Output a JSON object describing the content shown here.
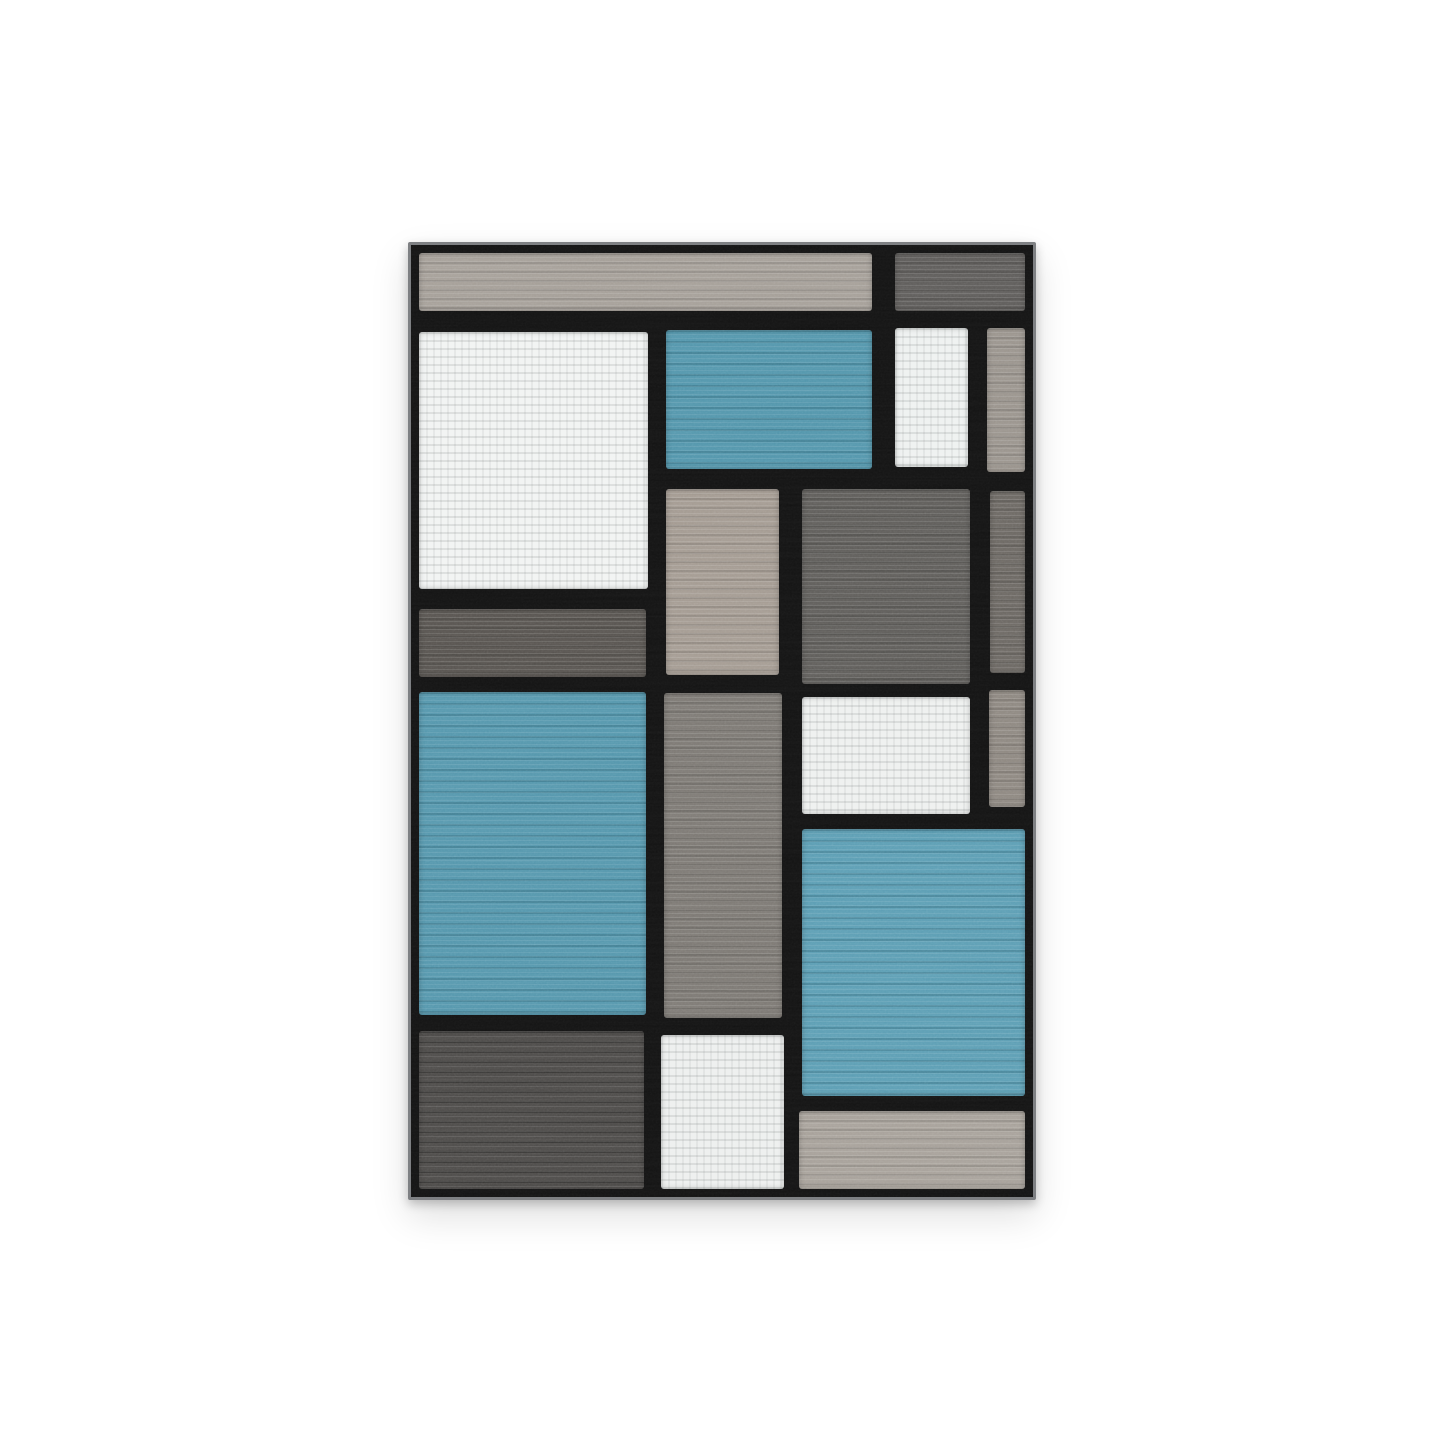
{
  "scene": {
    "description": "Product photo of a modern abstract color-block area rug with blue, gray, taupe and white rectangles separated by thick black grid lines, centered on a plain white background",
    "background_color": "#ffffff"
  },
  "rug": {
    "frame": {
      "left_pct": 28.24,
      "top_pct": 16.75,
      "width_pct": 43.46,
      "height_pct": 66.3
    },
    "grid_size": {
      "w": 628,
      "h": 958
    },
    "base_line_color": "#131313",
    "edge_binding_color": "#7e8083",
    "shadow": "0 4px 10px rgba(0,0,0,0.22), 0 16px 38px rgba(0,0,0,0.13)",
    "palette": {
      "teal_blue": "#5295ab",
      "light_taupe": "#a49e97",
      "warm_gray": "#99938c",
      "medium_gray": "#7c7873",
      "dark_gray": "#5e5c59",
      "charcoal": "#4c4a48",
      "off_white": "#f1f3f2",
      "black_line": "#131313"
    },
    "blocks": [
      {
        "name": "top-strip-taupe",
        "x": 8,
        "y": 8,
        "w": 457,
        "h": 58,
        "color": "#a49e97",
        "texture": "streaks"
      },
      {
        "name": "top-right-charcoal",
        "x": 489,
        "y": 8,
        "w": 131,
        "h": 58,
        "color": "#5d5b59",
        "texture": "streaks"
      },
      {
        "name": "upper-left-white",
        "x": 8,
        "y": 88,
        "w": 231,
        "h": 258,
        "color": "#f1f3f2",
        "texture": "speckle"
      },
      {
        "name": "upper-middle-blue",
        "x": 257,
        "y": 86,
        "w": 208,
        "h": 139,
        "color": "#5295ab",
        "texture": "blue"
      },
      {
        "name": "upper-white-small",
        "x": 489,
        "y": 83,
        "w": 73,
        "h": 140,
        "color": "#eef1f0",
        "texture": "speckle"
      },
      {
        "name": "upper-right-edge-gray",
        "x": 582,
        "y": 83,
        "w": 38,
        "h": 145,
        "color": "#99938c",
        "texture": "streaks"
      },
      {
        "name": "middle-tan",
        "x": 257,
        "y": 245,
        "w": 115,
        "h": 188,
        "color": "#a39a91",
        "texture": "streaks"
      },
      {
        "name": "middle-right-darkgray",
        "x": 395,
        "y": 246,
        "w": 169,
        "h": 196,
        "color": "#5e5c59",
        "texture": "streaks"
      },
      {
        "name": "right-edge-darkgray",
        "x": 585,
        "y": 248,
        "w": 35,
        "h": 183,
        "color": "#6b6762",
        "texture": "streaks"
      },
      {
        "name": "left-dark-strip",
        "x": 8,
        "y": 366,
        "w": 229,
        "h": 69,
        "color": "#57534f",
        "texture": "streaks"
      },
      {
        "name": "left-blue-large",
        "x": 8,
        "y": 450,
        "w": 229,
        "h": 325,
        "color": "#5496ac",
        "texture": "blue"
      },
      {
        "name": "center-gray-column",
        "x": 255,
        "y": 451,
        "w": 120,
        "h": 327,
        "color": "#7c7873",
        "texture": "streaks"
      },
      {
        "name": "center-right-white",
        "x": 395,
        "y": 455,
        "w": 169,
        "h": 118,
        "color": "#eef0ef",
        "texture": "speckle"
      },
      {
        "name": "right-edge-midgray",
        "x": 584,
        "y": 448,
        "w": 36,
        "h": 117,
        "color": "#8d8780",
        "texture": "streaks"
      },
      {
        "name": "right-blue-large",
        "x": 395,
        "y": 588,
        "w": 225,
        "h": 268,
        "color": "#5b9db3",
        "texture": "blue"
      },
      {
        "name": "bottom-left-charcoal",
        "x": 8,
        "y": 791,
        "w": 227,
        "h": 159,
        "color": "#4c4a48",
        "texture": "speckle-dark"
      },
      {
        "name": "bottom-center-white",
        "x": 252,
        "y": 795,
        "w": 125,
        "h": 155,
        "color": "#edefee",
        "texture": "speckle"
      },
      {
        "name": "bottom-right-lightgray",
        "x": 392,
        "y": 871,
        "w": 228,
        "h": 79,
        "color": "#a6a099",
        "texture": "streaks"
      }
    ]
  }
}
